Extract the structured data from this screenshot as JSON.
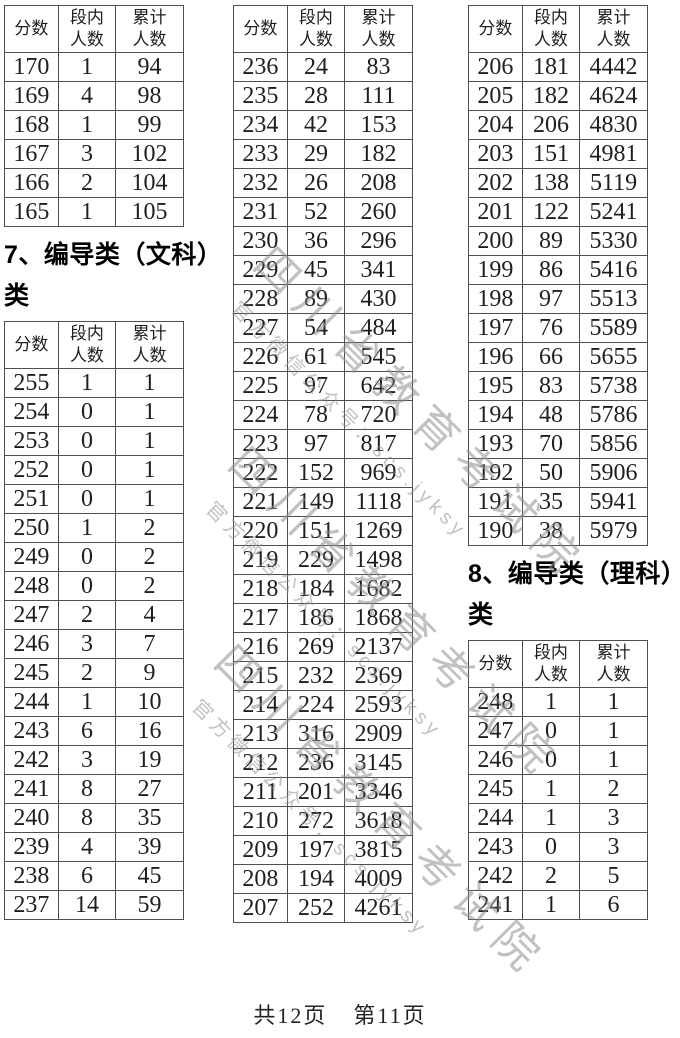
{
  "columns": [
    "分数",
    "段内\n人数",
    "累计\n人数"
  ],
  "sections": {
    "prev_tail": {
      "rows": [
        [
          "170",
          "1",
          "94"
        ],
        [
          "169",
          "4",
          "98"
        ],
        [
          "168",
          "1",
          "99"
        ],
        [
          "167",
          "3",
          "102"
        ],
        [
          "166",
          "2",
          "104"
        ],
        [
          "165",
          "1",
          "105"
        ]
      ]
    },
    "wenke": {
      "heading": "7、编导类（文科）类",
      "rows_col1": [
        [
          "255",
          "1",
          "1"
        ],
        [
          "254",
          "0",
          "1"
        ],
        [
          "253",
          "0",
          "1"
        ],
        [
          "252",
          "0",
          "1"
        ],
        [
          "251",
          "0",
          "1"
        ],
        [
          "250",
          "1",
          "2"
        ],
        [
          "249",
          "0",
          "2"
        ],
        [
          "248",
          "0",
          "2"
        ],
        [
          "247",
          "2",
          "4"
        ],
        [
          "246",
          "3",
          "7"
        ],
        [
          "245",
          "2",
          "9"
        ],
        [
          "244",
          "1",
          "10"
        ],
        [
          "243",
          "6",
          "16"
        ],
        [
          "242",
          "3",
          "19"
        ],
        [
          "241",
          "8",
          "27"
        ],
        [
          "240",
          "8",
          "35"
        ],
        [
          "239",
          "4",
          "39"
        ],
        [
          "238",
          "6",
          "45"
        ],
        [
          "237",
          "14",
          "59"
        ]
      ],
      "rows_col2": [
        [
          "236",
          "24",
          "83"
        ],
        [
          "235",
          "28",
          "111"
        ],
        [
          "234",
          "42",
          "153"
        ],
        [
          "233",
          "29",
          "182"
        ],
        [
          "232",
          "26",
          "208"
        ],
        [
          "231",
          "52",
          "260"
        ],
        [
          "230",
          "36",
          "296"
        ],
        [
          "229",
          "45",
          "341"
        ],
        [
          "228",
          "89",
          "430"
        ],
        [
          "227",
          "54",
          "484"
        ],
        [
          "226",
          "61",
          "545"
        ],
        [
          "225",
          "97",
          "642"
        ],
        [
          "224",
          "78",
          "720"
        ],
        [
          "223",
          "97",
          "817"
        ],
        [
          "222",
          "152",
          "969"
        ],
        [
          "221",
          "149",
          "1118"
        ],
        [
          "220",
          "151",
          "1269"
        ],
        [
          "219",
          "229",
          "1498"
        ],
        [
          "218",
          "184",
          "1682"
        ],
        [
          "217",
          "186",
          "1868"
        ],
        [
          "216",
          "269",
          "2137"
        ],
        [
          "215",
          "232",
          "2369"
        ],
        [
          "214",
          "224",
          "2593"
        ],
        [
          "213",
          "316",
          "2909"
        ],
        [
          "212",
          "236",
          "3145"
        ],
        [
          "211",
          "201",
          "3346"
        ],
        [
          "210",
          "272",
          "3618"
        ],
        [
          "209",
          "197",
          "3815"
        ],
        [
          "208",
          "194",
          "4009"
        ],
        [
          "207",
          "252",
          "4261"
        ]
      ],
      "rows_col3": [
        [
          "206",
          "181",
          "4442"
        ],
        [
          "205",
          "182",
          "4624"
        ],
        [
          "204",
          "206",
          "4830"
        ],
        [
          "203",
          "151",
          "4981"
        ],
        [
          "202",
          "138",
          "5119"
        ],
        [
          "201",
          "122",
          "5241"
        ],
        [
          "200",
          "89",
          "5330"
        ],
        [
          "199",
          "86",
          "5416"
        ],
        [
          "198",
          "97",
          "5513"
        ],
        [
          "197",
          "76",
          "5589"
        ],
        [
          "196",
          "66",
          "5655"
        ],
        [
          "195",
          "83",
          "5738"
        ],
        [
          "194",
          "48",
          "5786"
        ],
        [
          "193",
          "70",
          "5856"
        ],
        [
          "192",
          "50",
          "5906"
        ],
        [
          "191",
          "35",
          "5941"
        ],
        [
          "190",
          "38",
          "5979"
        ]
      ]
    },
    "like": {
      "heading": "8、编导类（理科）类",
      "rows": [
        [
          "248",
          "1",
          "1"
        ],
        [
          "247",
          "0",
          "1"
        ],
        [
          "246",
          "0",
          "1"
        ],
        [
          "245",
          "1",
          "2"
        ],
        [
          "244",
          "1",
          "3"
        ],
        [
          "243",
          "0",
          "3"
        ],
        [
          "242",
          "2",
          "5"
        ],
        [
          "241",
          "1",
          "6"
        ]
      ]
    }
  },
  "watermark": {
    "title": "四川省教育考试院",
    "subtitle": "官方微信公众号：scs.jyksy"
  },
  "footer": {
    "total": "共12页",
    "current": "第11页"
  }
}
